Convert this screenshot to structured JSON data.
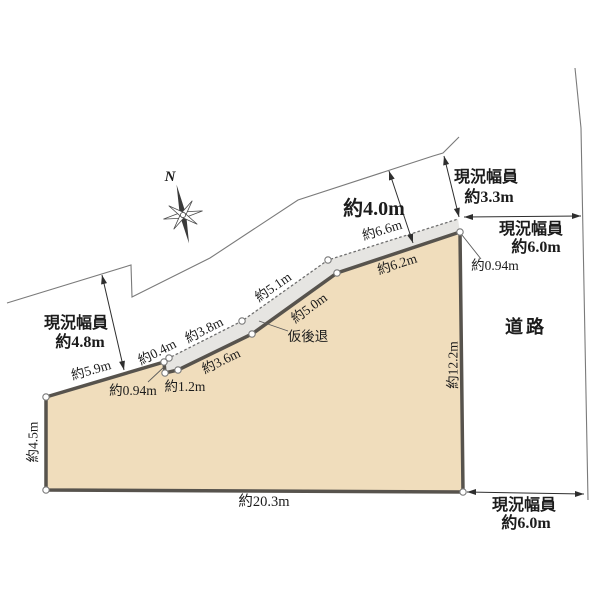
{
  "compass": {
    "north": "N"
  },
  "road_area": {
    "label": "道路"
  },
  "width_labels": {
    "left": {
      "line1": "現況幅員",
      "line2": "約4.8m"
    },
    "top": {
      "line1": "現況幅員",
      "line2": "約3.3m"
    },
    "right_top": {
      "line1": "現況幅員",
      "line2": "約6.0m"
    },
    "right_bottom": {
      "line1": "現況幅員",
      "line2": "約6.0m"
    }
  },
  "measurements": {
    "road_offset_top": "約4.0m",
    "edge_nw": "約5.9m",
    "edge_left": "約4.5m",
    "edge_bottom": "約20.3m",
    "edge_right": "約12.2m",
    "boundary_04": "約0.4m",
    "boundary_38": "約3.8m",
    "boundary_51": "約5.1m",
    "boundary_66": "約6.6m",
    "setback_36": "約3.6m",
    "setback_50": "約5.0m",
    "setback_62": "約6.2m",
    "notch_depth": "約0.94m",
    "notch_width": "約1.2m",
    "corner_depth": "約0.94m",
    "setback_label": "仮後退"
  },
  "colors": {
    "parcel_fill": "#f0ddbc",
    "setback_fill": "#e6e5e2",
    "boundary_stroke": "#57534d",
    "thin_line": "#7a7a7a",
    "text": "#1c1c1c"
  }
}
